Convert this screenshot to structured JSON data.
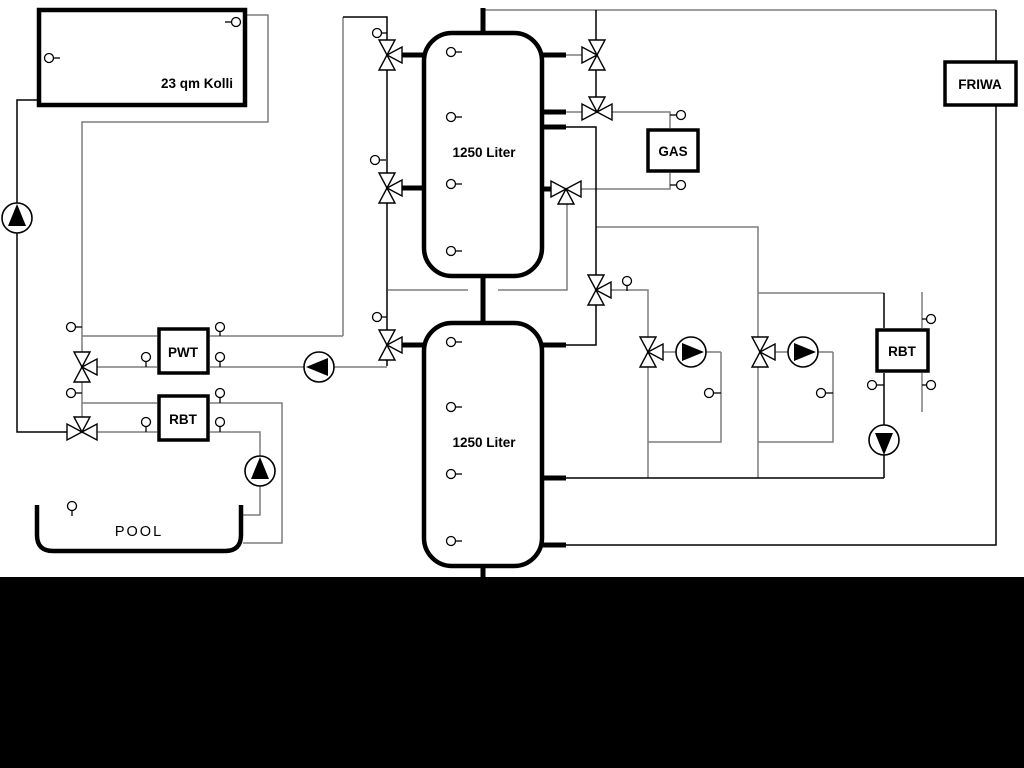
{
  "labels": {
    "collector": "23 qm Kolli",
    "tank_top": "1250 Liter",
    "tank_bottom": "1250 Liter",
    "gas": "GAS",
    "friwa": "FRIWA",
    "pwt": "PWT",
    "rbt_left": "RBT",
    "rbt_right": "RBT",
    "pool": "POOL"
  },
  "colors": {
    "background": "#ffffff",
    "pipe_gray": "#7d7d7d",
    "pipe_black": "#000000",
    "bottom_band": "#000000"
  },
  "components": {
    "boxes": [
      "solar-collector",
      "buffer-tank-1",
      "buffer-tank-2",
      "gas-boiler",
      "friwa-station",
      "plate-heat-exchanger",
      "rbt-left",
      "rbt-right",
      "pool-basin"
    ],
    "pumps": [
      "solar-pump",
      "pwt-charge-pump",
      "heating-circuit-1-pump",
      "heating-circuit-2-pump",
      "rbt-right-pump",
      "pool-pump"
    ],
    "three_way_valves": 11,
    "temperature_sensors": 30
  }
}
